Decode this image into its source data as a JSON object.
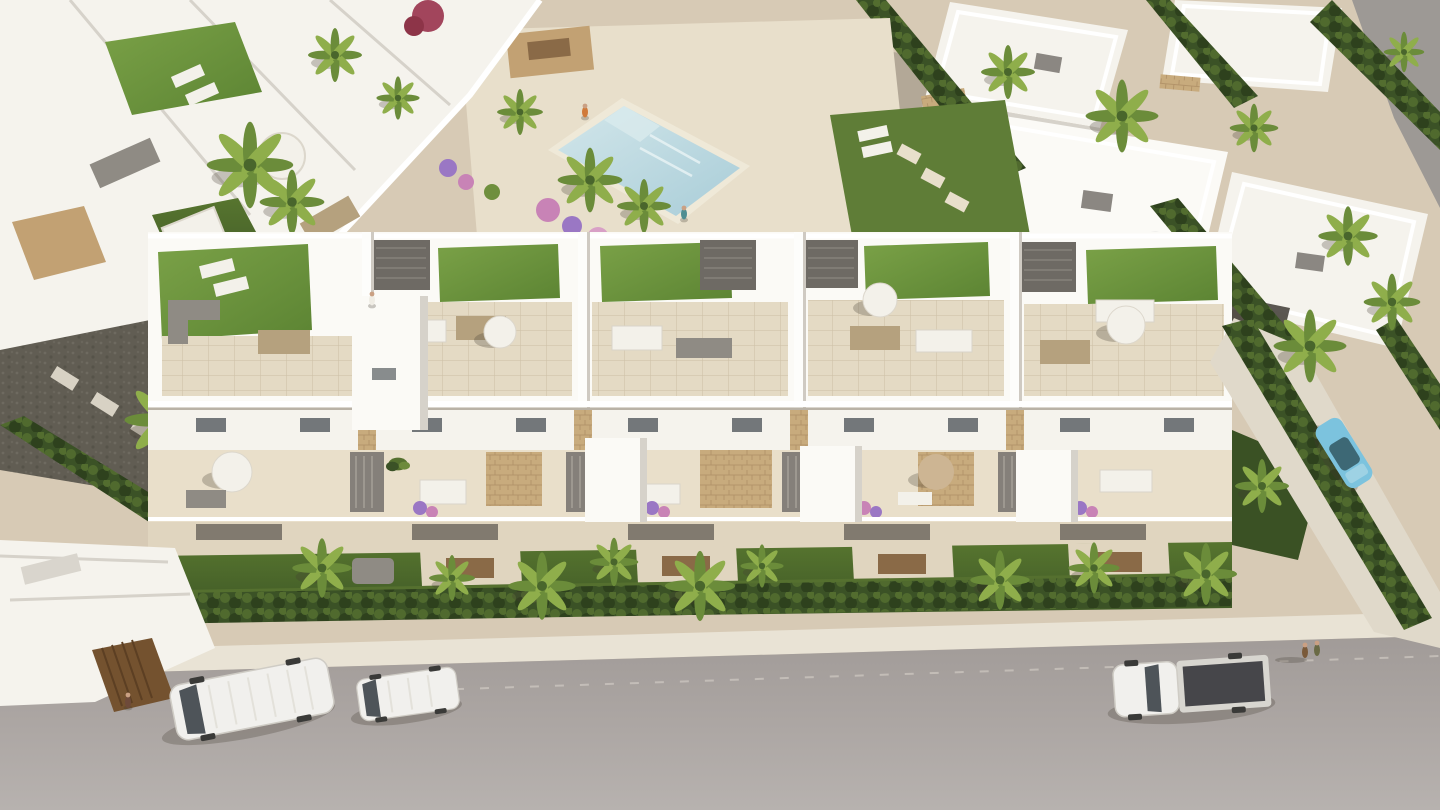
{
  "image": {
    "type": "3d-architectural-rendering",
    "view": "aerial-oblique",
    "description": "Aerial CGI rendering of a white modern residential complex: a long five-unit townhouse block with rooftop terraces (artificial turf, parasols, lounge and dining furniture), balcony terraces with flower planters, private lawns behind a clipped hedge, a communal rotated-square swimming pool surrounded by palms and flower beds, neighbouring white villas, and a grey street in the foreground with a white van, a compact van and a white pickup truck parked along it."
  },
  "palette": {
    "base_paving": "#d7cab5",
    "paving_light": "#e3d8c3",
    "deck_light": "#e8dfcb",
    "wall_white": "#f5f3ed",
    "wall_bright": "#fbfaf6",
    "wall_shade": "#d6d2ca",
    "wall_dark": "#b9b5ad",
    "tile": "#e4dac4",
    "stone": "#c8ab7d",
    "stone_line": "#b3946a",
    "wood": "#8a6a47",
    "wood_dark": "#6f5236",
    "gate_brown": "#74522f",
    "turf": "#6e9540",
    "turf_dark": "#567c31",
    "lawn": "#4e6a2f",
    "lawn_dark": "#3a5124",
    "hedge": "#3b5226",
    "hedge_light": "#55702f",
    "hedge_dark": "#2c3f1c",
    "palm": "#6b8c3a",
    "palm_light": "#8fae4b",
    "palm_dark": "#49662c",
    "gravel_dark": "#615d53",
    "gravel": "#b3a897",
    "pool_water": "#bdd9e0",
    "pool_light": "#d8eaec",
    "pool_coping": "#efe9d8",
    "road": "#a9a39f",
    "road_light": "#b7b2ae",
    "sidewalk": "#e9e3d5",
    "furn_gray": "#8f8b84",
    "furn_white": "#f3f1ea",
    "furn_tan": "#b5a17e",
    "screen_gray": "#85807a",
    "glass_dark": "#3c4248",
    "car_white": "#f1f0ed",
    "truck_bed": "#46464a",
    "car_blue": "#7b9ed0",
    "car_blue_roof": "#8fb0da",
    "car_teal": "#7cc3de",
    "car_teal_glass": "#335863",
    "flower_pink": "#c883b6",
    "flower_purple": "#9a77c4",
    "flower_red": "#a2455c",
    "skin": "#caa083",
    "shirt_orange": "#d07a3a",
    "shirt_teal": "#4f8e92",
    "shirt_dark": "#6e4a3a",
    "shadow": "rgba(70,62,52,0.28)"
  },
  "complex": {
    "main_block_units": 5,
    "rooftop_features": [
      "artificial turf lawns",
      "white parapet walls",
      "lounge sofas",
      "dining sets",
      "white and tan parasols",
      "dark louvered pergola boxes"
    ],
    "terrace_features": [
      "planters with purple and pink flowers",
      "green shrubs",
      "slatted privacy screens",
      "stone-clad accent walls",
      "white stair towers"
    ],
    "ground_features": [
      "private lawns",
      "dining patios with wooden tables",
      "grey daybed",
      "continuous clipped perimeter hedge"
    ]
  },
  "pool_area": {
    "pool_shape": "rotated-square",
    "water_color": "#bdd9e0",
    "deck": "light beige paving",
    "features": [
      "corner entry steps",
      "banana palms",
      "pink and purple flower beds",
      "lawn with stepping stones",
      "timber deck with dining table"
    ]
  },
  "street": {
    "surface": "grey asphalt",
    "sidewalk": "light concrete kerb",
    "parked_vehicle_count": 3
  },
  "vehicles": [
    {
      "name": "white-van",
      "color": "#f1f0ed",
      "location": "street bottom-left"
    },
    {
      "name": "white-compact-van",
      "color": "#f1f0ed",
      "location": "street bottom-centre-left"
    },
    {
      "name": "white-pickup-truck",
      "color": "#f1f0ed",
      "bed_color": "#46464a",
      "location": "street bottom-right"
    },
    {
      "name": "blue-hatchback",
      "color": "#7b9ed0",
      "location": "villa driveway top-right"
    },
    {
      "name": "light-blue-sedan",
      "color": "#7cc3de",
      "location": "side street right edge"
    },
    {
      "name": "parked-white-car",
      "color": "#f1f0ed",
      "location": "top-right lane"
    }
  ],
  "people": [
    {
      "location": "pool deck, orange swim shorts"
    },
    {
      "location": "path behind main block"
    },
    {
      "location": "rooftop terrace of left unit"
    },
    {
      "location": "gateway bottom-left"
    },
    {
      "location": "sidewalk bottom-right, pair walking"
    }
  ],
  "vegetation": {
    "palm_trees": "about 20 fan palms plus banana palms",
    "hedges": "dark clipped hedges along street, boundaries and top-right villas",
    "flower_colors": [
      "pink",
      "purple",
      "magenta"
    ]
  }
}
